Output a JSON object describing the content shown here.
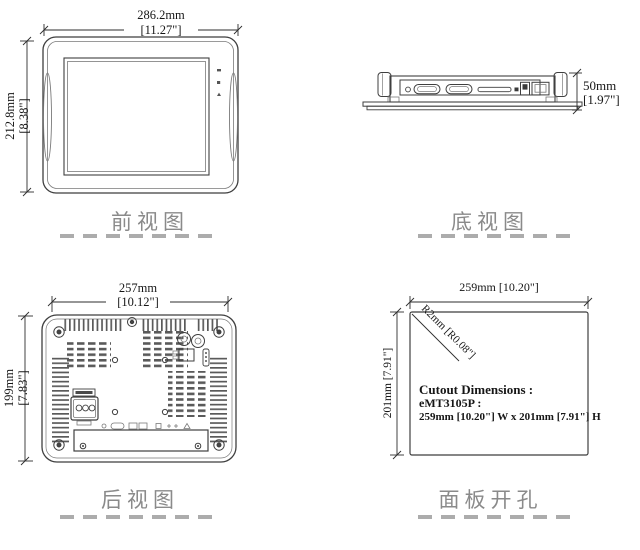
{
  "views": {
    "front": {
      "label": "前视图",
      "dim_width_mm": "286.2mm",
      "dim_width_in": "[11.27\"]",
      "dim_height_mm": "212.8mm",
      "dim_height_in": "[8.38\"]"
    },
    "bottom": {
      "label": "底视图",
      "dim_depth_mm": "50mm",
      "dim_depth_in": "[1.97\"]"
    },
    "rear": {
      "label": "后视图",
      "dim_width_mm": "257mm",
      "dim_width_in": "[10.12\"]",
      "dim_height_mm": "199mm",
      "dim_height_in": "[7.83\"]"
    },
    "cutout": {
      "label": "面板开孔",
      "dim_width": "259mm [10.20\"]",
      "dim_height": "201mm [7.91\"]",
      "dim_radius": "R2mm [R0.08\"]",
      "note": {
        "line1": "Cutout Dimensions :",
        "line2": "eMT3105P :",
        "line3": "259mm [10.20\"] W x 201mm [7.91\"] H"
      }
    }
  },
  "colors": {
    "line_art": "#3f3f3f",
    "dimension_text": "#161616",
    "view_label_text": "#8a8a8a",
    "divider_dash": "#acacac"
  }
}
